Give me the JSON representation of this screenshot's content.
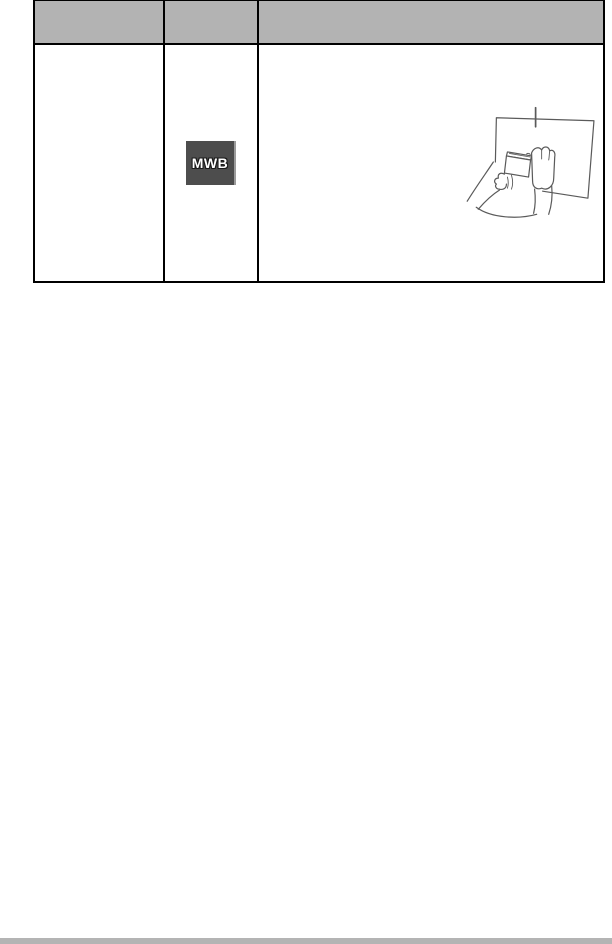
{
  "page": {
    "background_color": "#ffffff",
    "bottom_bar_color": "#b4b4b4"
  },
  "table": {
    "border_color": "#000000",
    "header": {
      "fill_color": "#b3b3b3",
      "columns": [
        {
          "label": ""
        },
        {
          "label": ""
        },
        {
          "label": ""
        }
      ]
    },
    "body_row": {
      "cell_1_text": "",
      "mode_icon": {
        "label": "MWB",
        "background_color": "#4d4d4d",
        "text_color": "#ffffff",
        "edge_highlight_color": "#9b9b9b"
      },
      "illustration": {
        "name": "hands-holding-camera-at-white-paper",
        "stroke_color": "#5a5a5a",
        "paper_fill": "#ffffff"
      }
    }
  }
}
